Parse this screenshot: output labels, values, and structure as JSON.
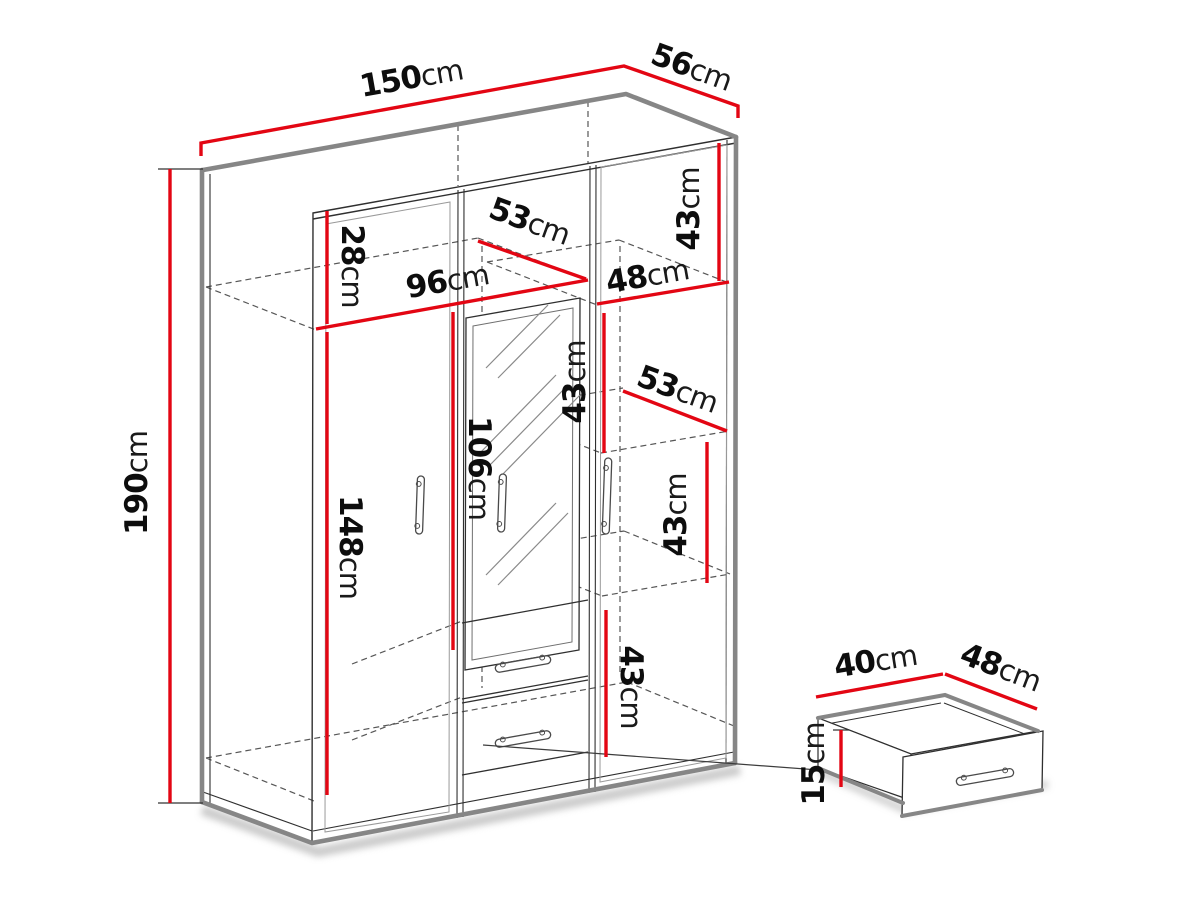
{
  "diagram_type": "furniture-dimension-diagram",
  "colors": {
    "dimension_line": "#e30613",
    "silhouette_edge": "#868686",
    "outline_thin": "#2f2f2f",
    "dashed_line": "#565656",
    "background": "#ffffff",
    "label_text": "#0d0d0d"
  },
  "wardrobe_dimensions": [
    {
      "id": "overall-width",
      "value": "150",
      "unit": "cm"
    },
    {
      "id": "overall-depth",
      "value": "56",
      "unit": "cm"
    },
    {
      "id": "overall-height",
      "value": "190",
      "unit": "cm"
    },
    {
      "id": "top-shelf-compartment-height",
      "value": "28",
      "unit": "cm"
    },
    {
      "id": "shelf-depth-upper",
      "value": "53",
      "unit": "cm"
    },
    {
      "id": "left-section-width",
      "value": "96",
      "unit": "cm"
    },
    {
      "id": "right-section-width",
      "value": "48",
      "unit": "cm"
    },
    {
      "id": "right-top-compartment-height",
      "value": "43",
      "unit": "cm"
    },
    {
      "id": "shelf-depth-middle",
      "value": "53",
      "unit": "cm"
    },
    {
      "id": "divider-compartment-height",
      "value": "43",
      "unit": "cm"
    },
    {
      "id": "right-mid-compartment-height",
      "value": "43",
      "unit": "cm"
    },
    {
      "id": "mirror-height",
      "value": "106",
      "unit": "cm"
    },
    {
      "id": "hanging-space-height",
      "value": "148",
      "unit": "cm"
    },
    {
      "id": "drawer-section-height",
      "value": "43",
      "unit": "cm"
    }
  ],
  "drawer_dimensions": [
    {
      "id": "drawer-width",
      "value": "40",
      "unit": "cm"
    },
    {
      "id": "drawer-depth",
      "value": "48",
      "unit": "cm"
    },
    {
      "id": "drawer-height",
      "value": "15",
      "unit": "cm"
    }
  ]
}
